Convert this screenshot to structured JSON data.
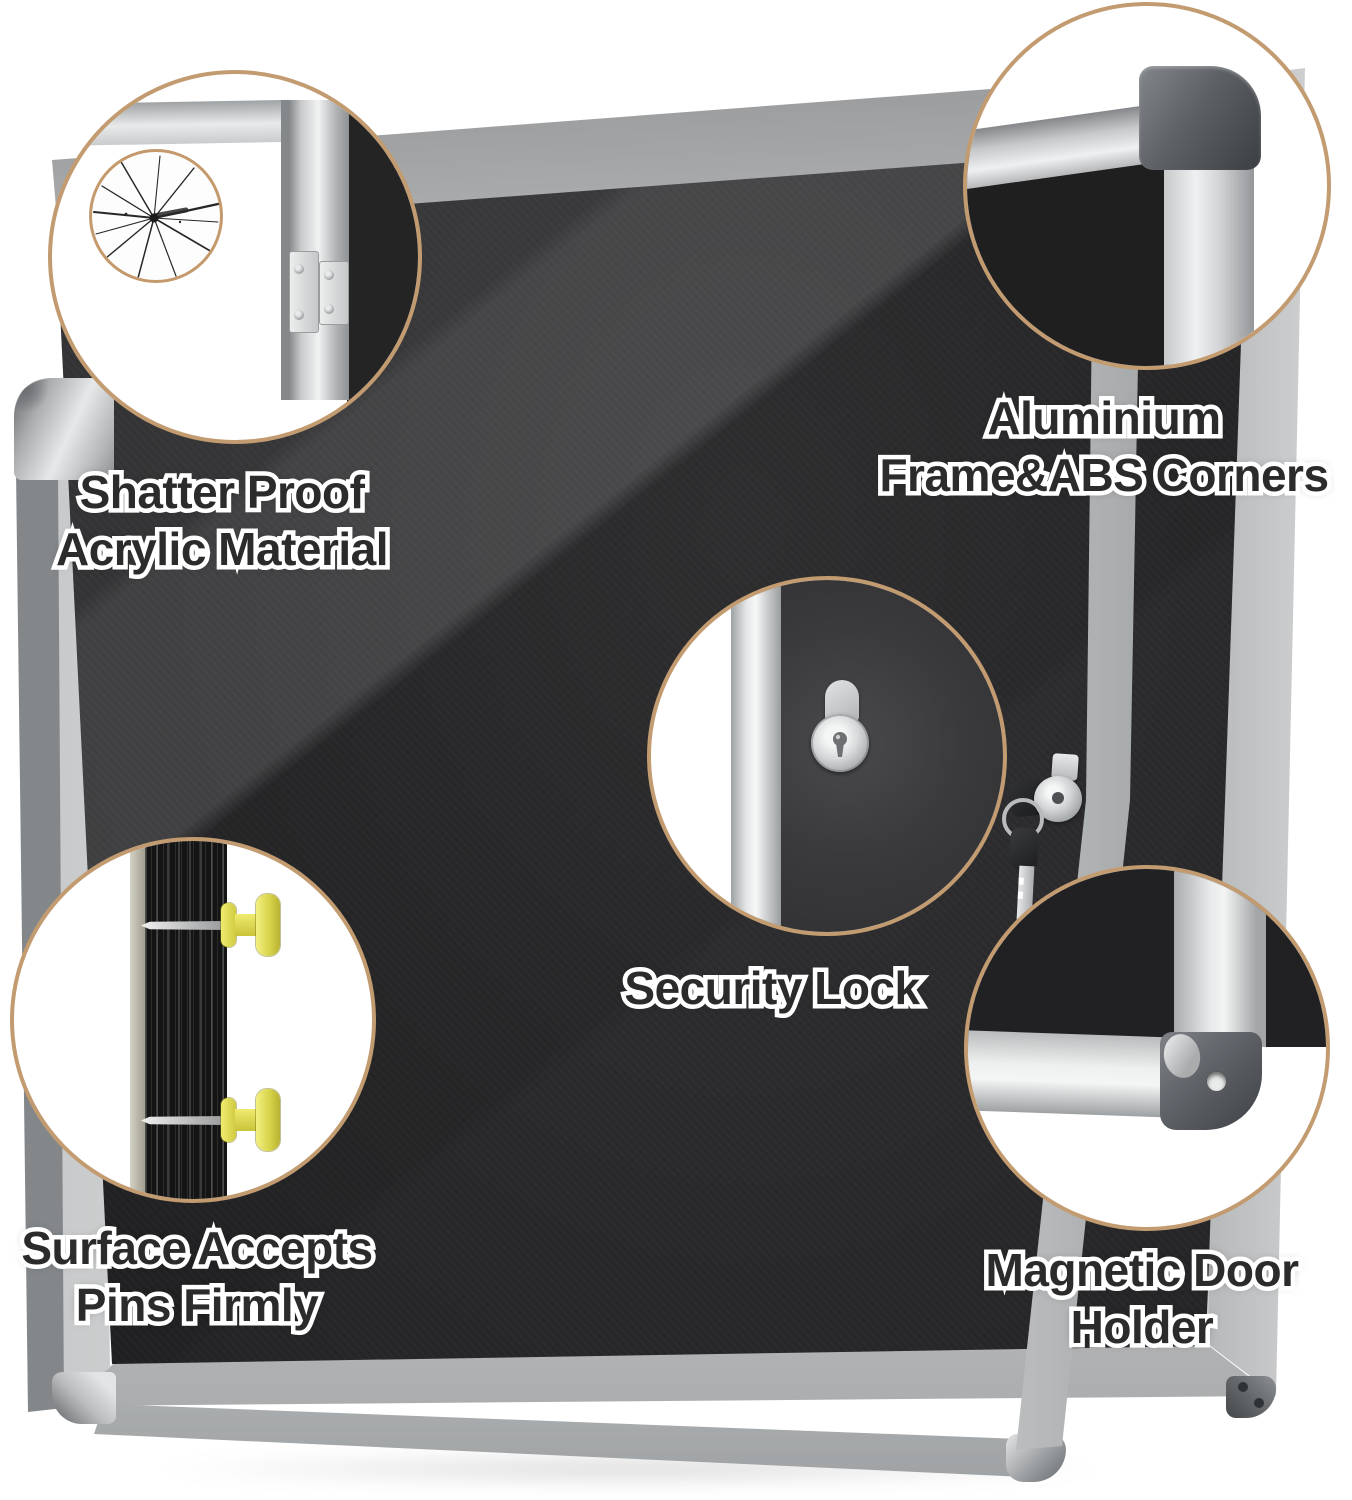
{
  "features": [
    {
      "id": "shatter-proof",
      "line1": "Shatter Proof",
      "line2": "Acrylic Material",
      "icon": "cracked-acrylic-icon"
    },
    {
      "id": "aluminium-frame",
      "line1": "Aluminium",
      "line2": "Frame&ABS Corners",
      "icon": "frame-corner-icon"
    },
    {
      "id": "security-lock",
      "line1": "Security Lock",
      "line2": "",
      "icon": "lock-cylinder-icon"
    },
    {
      "id": "pin-surface",
      "line1": "Surface Accepts",
      "line2": "Pins Firmly",
      "icon": "push-pin-icon"
    },
    {
      "id": "magnetic-holder",
      "line1": "Magnetic Door",
      "line2": "Holder",
      "icon": "magnet-corner-icon"
    }
  ],
  "colors": {
    "background": "#ffffff",
    "callout_ring": "#c29b70",
    "felt_black": "#2a2a2c",
    "frame_silver": "#d9dadb",
    "abs_corner_gray": "#5d6165",
    "pin_yellow": "#e9e45e",
    "key_black": "#232425",
    "label_fill": "#2b2b2b",
    "label_outline": "#ffffff"
  }
}
